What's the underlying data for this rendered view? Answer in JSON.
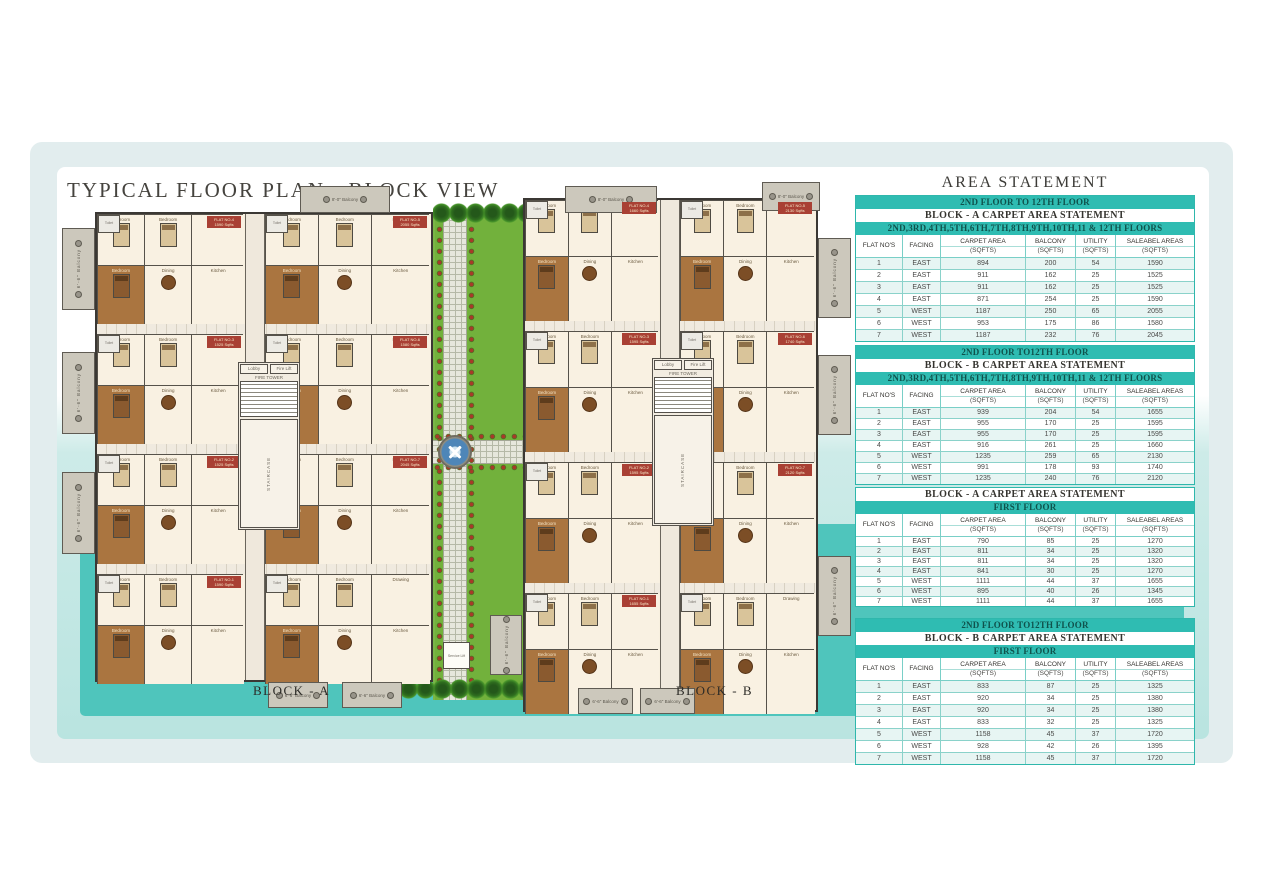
{
  "page": {
    "title": "TYPICAL FLOOR PLAN - BLOCK VIEW"
  },
  "colors": {
    "teal_band": "#2fbcb2",
    "teal_panel": "#4fc5bc",
    "panel_blue": "#e2edee",
    "lawn_green": "#72b13c",
    "flat_badge_red": "#a94034",
    "master_bedroom_brown": "#aa7540",
    "plan_cream": "#f8f0df"
  },
  "area_statement": {
    "title": "AREA STATEMENT",
    "columns": [
      {
        "label": "FLAT NO'S"
      },
      {
        "label": "FACING"
      },
      {
        "label": "CARPET AREA",
        "sub": "(SQFTS)"
      },
      {
        "label": "BALCONY",
        "sub": "(SQFTS)"
      },
      {
        "label": "UTILITY",
        "sub": "(SQFTS)"
      },
      {
        "label": "SALEABEL AREAS",
        "sub": "(SQFTS)"
      }
    ],
    "tables": [
      {
        "floor_band": "2ND FLOOR TO 12TH FLOOR",
        "block_band": "BLOCK - A  CARPET AREA STATEMENT",
        "floors_band": "2ND,3RD,4TH,5TH,6TH,7TH,8TH,9TH,10TH,11 & 12TH FLOORS",
        "rows": [
          [
            "1",
            "EAST",
            "894",
            "200",
            "54",
            "1590"
          ],
          [
            "2",
            "EAST",
            "911",
            "162",
            "25",
            "1525"
          ],
          [
            "3",
            "EAST",
            "911",
            "162",
            "25",
            "1525"
          ],
          [
            "4",
            "EAST",
            "871",
            "254",
            "25",
            "1590"
          ],
          [
            "5",
            "WEST",
            "1187",
            "250",
            "65",
            "2055"
          ],
          [
            "6",
            "WEST",
            "953",
            "175",
            "86",
            "1580"
          ],
          [
            "7",
            "WEST",
            "1187",
            "232",
            "76",
            "2045"
          ]
        ]
      },
      {
        "floor_band": "2ND FLOOR TO12TH FLOOR",
        "block_band": "BLOCK - B  CARPET AREA STATEMENT",
        "floors_band": "2ND,3RD,4TH,5TH,6TH,7TH,8TH,9TH,10TH,11 & 12TH FLOORS",
        "rows": [
          [
            "1",
            "EAST",
            "939",
            "204",
            "54",
            "1655"
          ],
          [
            "2",
            "EAST",
            "955",
            "170",
            "25",
            "1595"
          ],
          [
            "3",
            "EAST",
            "955",
            "170",
            "25",
            "1595"
          ],
          [
            "4",
            "EAST",
            "916",
            "261",
            "25",
            "1660"
          ],
          [
            "5",
            "WEST",
            "1235",
            "259",
            "65",
            "2130"
          ],
          [
            "6",
            "WEST",
            "991",
            "178",
            "93",
            "1740"
          ],
          [
            "7",
            "WEST",
            "1235",
            "240",
            "76",
            "2120"
          ]
        ]
      },
      {
        "floor_band": null,
        "block_band": "BLOCK - A  CARPET AREA STATEMENT",
        "floors_band": "FIRST FLOOR",
        "rows": [
          [
            "1",
            "EAST",
            "790",
            "85",
            "25",
            "1270"
          ],
          [
            "2",
            "EAST",
            "811",
            "34",
            "25",
            "1320"
          ],
          [
            "3",
            "EAST",
            "811",
            "34",
            "25",
            "1320"
          ],
          [
            "4",
            "EAST",
            "841",
            "30",
            "25",
            "1270"
          ],
          [
            "5",
            "WEST",
            "1111",
            "44",
            "37",
            "1655"
          ],
          [
            "6",
            "WEST",
            "895",
            "40",
            "26",
            "1345"
          ],
          [
            "7",
            "WEST",
            "1111",
            "44",
            "37",
            "1655"
          ]
        ]
      },
      {
        "floor_band": "2ND FLOOR TO12TH FLOOR",
        "block_band": "BLOCK - B  CARPET AREA STATEMENT",
        "floors_band": "FIRST FLOOR",
        "rows": [
          [
            "1",
            "EAST",
            "833",
            "87",
            "25",
            "1325"
          ],
          [
            "2",
            "EAST",
            "920",
            "34",
            "25",
            "1380"
          ],
          [
            "3",
            "EAST",
            "920",
            "34",
            "25",
            "1380"
          ],
          [
            "4",
            "EAST",
            "833",
            "32",
            "25",
            "1325"
          ],
          [
            "5",
            "WEST",
            "1158",
            "45",
            "37",
            "1720"
          ],
          [
            "6",
            "WEST",
            "928",
            "42",
            "26",
            "1395"
          ],
          [
            "7",
            "WEST",
            "1158",
            "45",
            "37",
            "1720"
          ]
        ]
      }
    ]
  },
  "floorplan": {
    "rooms": {
      "bedroom": "Bedroom",
      "master": "Bedroom",
      "drawing": "Drawing",
      "dining": "Dining",
      "kitchen": "Kitchen",
      "toilet": "Toilet"
    },
    "labels": {
      "corridor": "7'-6\" WIDE CORRIDOR",
      "fire_tower": "FIRE TOWER",
      "lobby": "Lobby",
      "fire_lift": "Fire Lift",
      "staircase": "STAIRCASE",
      "service_lift": "Service Lift",
      "balcony_top": "8'-0\" Balcony",
      "balcony_side": "6'-6\" Balcony"
    },
    "blocks": [
      {
        "label": "BLOCK - A",
        "left_flats": [
          [
            "FLAT NO-4",
            "1590 Sqfts"
          ],
          [
            "FLAT NO-3",
            "1525 Sqfts"
          ],
          [
            "FLAT NO-2",
            "1525 Sqfts"
          ],
          [
            "FLAT NO-1",
            "1590 Sqfts"
          ]
        ],
        "right_flats": [
          [
            "FLAT NO-5",
            "2055 Sqfts"
          ],
          [
            "FLAT NO-6",
            "1580 Sqfts"
          ],
          [
            "FLAT NO-7",
            "2045 Sqfts"
          ],
          null
        ]
      },
      {
        "label": "BLOCK - B",
        "left_flats": [
          [
            "FLAT NO-4",
            "1660 Sqfts"
          ],
          [
            "FLAT NO-3",
            "1595 Sqfts"
          ],
          [
            "FLAT NO-2",
            "1595 Sqfts"
          ],
          [
            "FLAT NO-1",
            "1655 Sqfts"
          ]
        ],
        "right_flats": [
          [
            "FLAT NO-5",
            "2130 Sqfts"
          ],
          [
            "FLAT NO-6",
            "1740 Sqfts"
          ],
          [
            "FLAT NO-7",
            "2120 Sqfts"
          ],
          null
        ]
      }
    ]
  }
}
